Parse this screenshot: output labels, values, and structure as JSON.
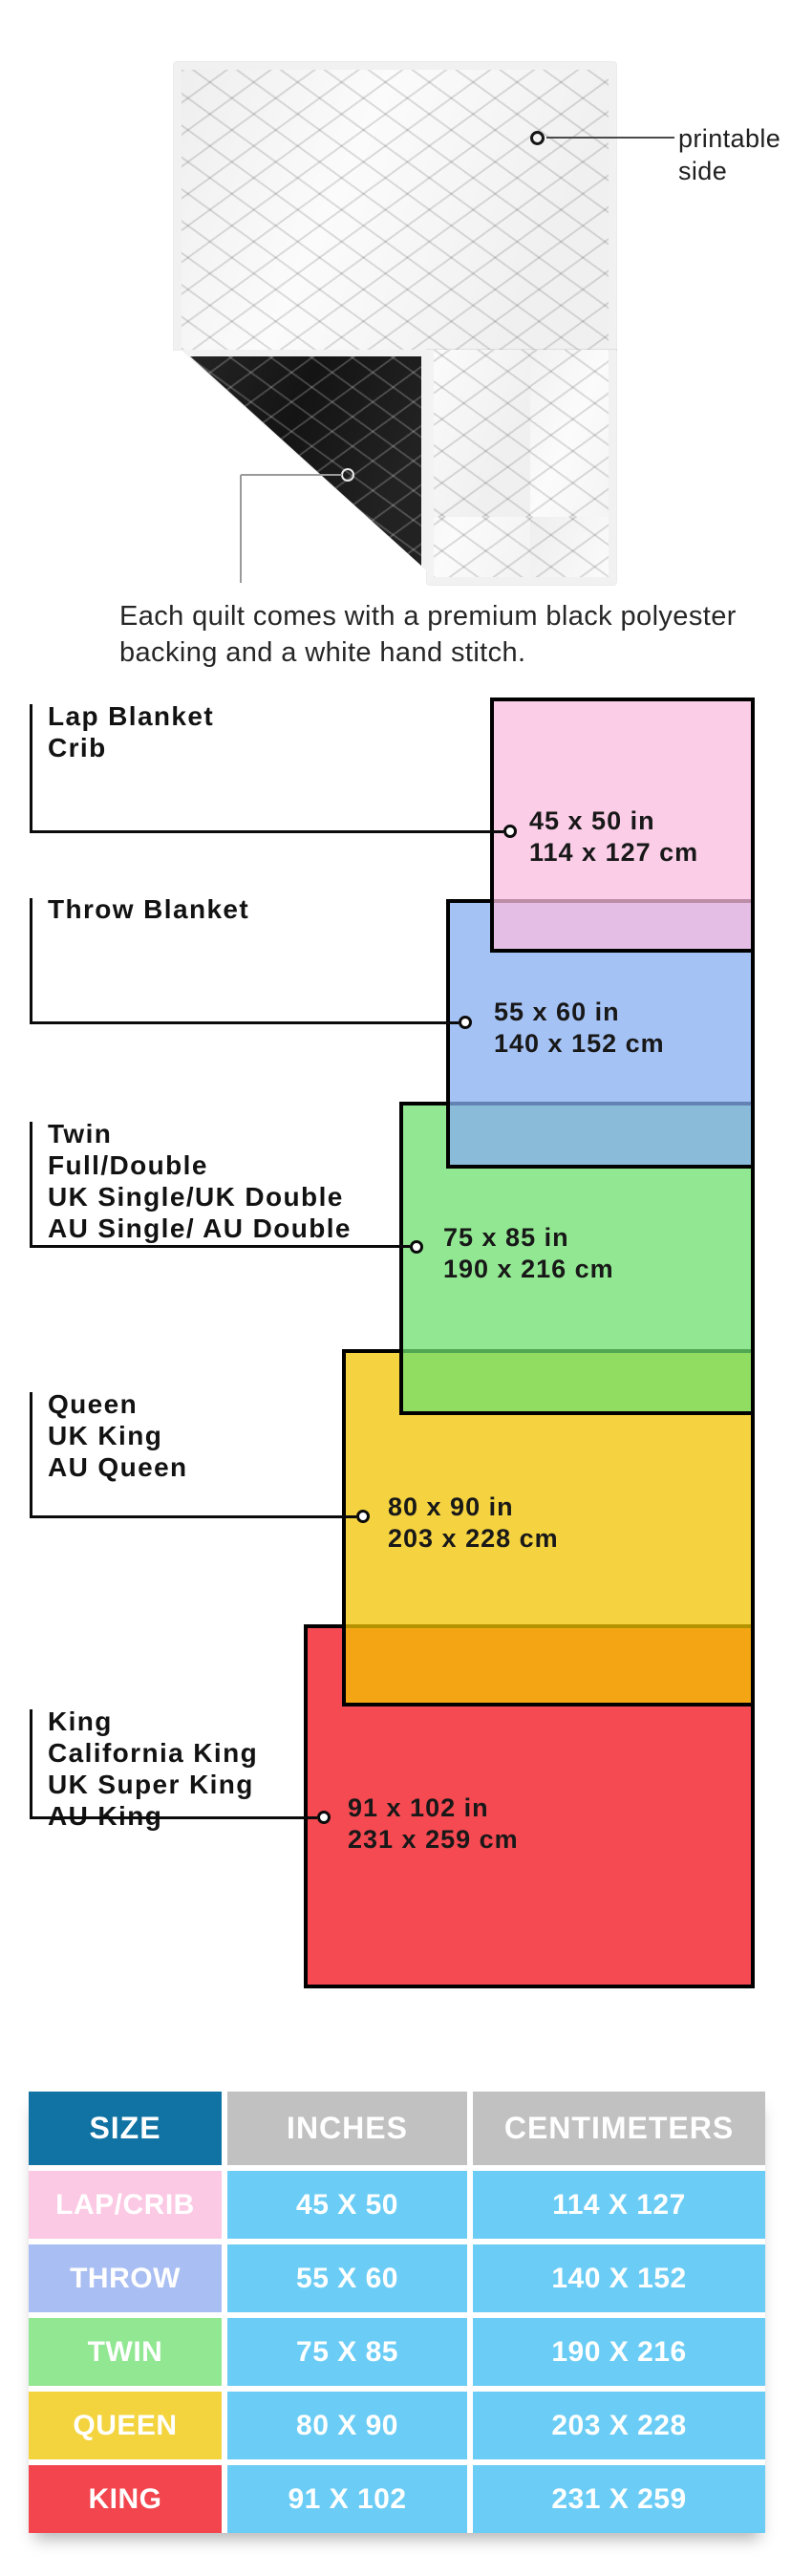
{
  "quilt_section": {
    "printable_label_line1": "printable",
    "printable_label_line2": "side",
    "caption_line1": "Each quilt comes with a premium black polyester",
    "caption_line2": "backing and a white hand stitch.",
    "front_color": "#fbfbfb",
    "back_color": "#141414"
  },
  "size_diagram": {
    "fill_opacity": 0.75,
    "border_color": "#000000",
    "groups": [
      {
        "id": "lap",
        "label_lines": [
          "Lap Blanket",
          "Crib"
        ],
        "inches": "45 x 50 in",
        "cm": "114 x 127 cm",
        "fill_rgb": [
          250,
          188,
          223
        ],
        "fill_over_white": "#fbcde9"
      },
      {
        "id": "throw",
        "label_lines": [
          "Throw Blanket"
        ],
        "inches": "55 x 60 in",
        "cm": "140 x 152 cm",
        "fill_rgb": [
          135,
          174,
          240
        ],
        "fill_over_white": "#a5c2f4"
      },
      {
        "id": "twin",
        "label_lines": [
          "Twin",
          "Full/Double",
          "UK Single/UK Double",
          "AU Single/ AU Double"
        ],
        "inches": "75 x 85 in",
        "cm": "190 x 216 cm",
        "fill_rgb": [
          110,
          224,
          110
        ],
        "fill_over_white": "#92e892"
      },
      {
        "id": "queen",
        "label_lines": [
          "Queen",
          "UK King",
          "AU Queen"
        ],
        "inches": "80 x 90 in",
        "cm": "203 x 228 cm",
        "fill_rgb": [
          242,
          196,
          0
        ],
        "fill_over_white": "#f5d340"
      },
      {
        "id": "king",
        "label_lines": [
          "King",
          "California King",
          "UK Super King",
          "AU King"
        ],
        "inches": "91 x 102 in",
        "cm": "231 x 259 cm",
        "fill_rgb": [
          242,
          14,
          24
        ],
        "fill_over_white": "#f54a52"
      }
    ]
  },
  "size_table": {
    "headers": [
      "SIZE",
      "INCHES",
      "CENTIMETERS"
    ],
    "header_size_bg": "#1173a3",
    "header_other_bg": "#c1c1c1",
    "cell_bg": "#6bcdf5",
    "text_color": "#ffffff",
    "rows": [
      {
        "size": "LAP/CRIB",
        "inches": "45 X 50",
        "cm": "114 X 127",
        "size_bg": "#fbc9e3"
      },
      {
        "size": "THROW",
        "inches": "55 X 60",
        "cm": "140 X 152",
        "size_bg": "#a9bef2"
      },
      {
        "size": "TWIN",
        "inches": "75 X 85",
        "cm": "190 X 216",
        "size_bg": "#92e793"
      },
      {
        "size": "QUEEN",
        "inches": "80 X 90",
        "cm": "203 X 228",
        "size_bg": "#f3d43e"
      },
      {
        "size": "KING",
        "inches": "91 X 102",
        "cm": "231 X 259",
        "size_bg": "#f2454e"
      }
    ]
  }
}
